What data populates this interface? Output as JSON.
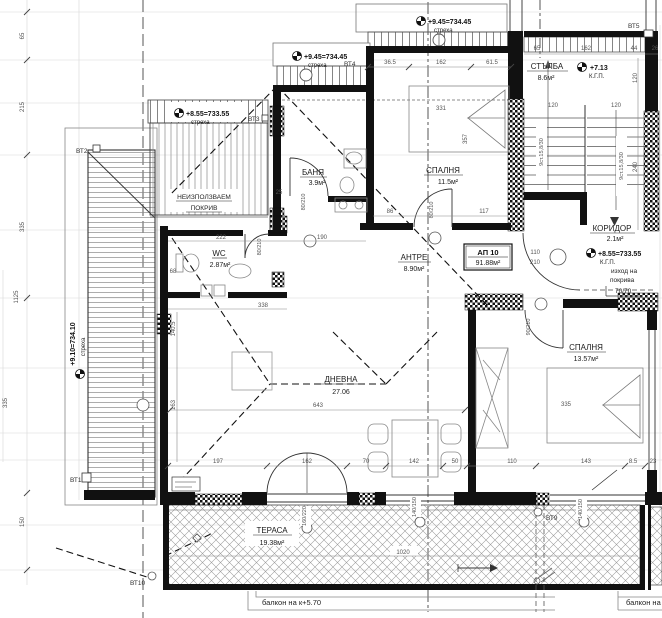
{
  "apartment": {
    "label": "АП 10",
    "area": "91.88м²"
  },
  "rooms": [
    {
      "name": "БАНЯ",
      "area": "3.9м²"
    },
    {
      "name": "СПАЛНЯ",
      "area": "11.5м²"
    },
    {
      "name": "СТЪЛБА",
      "area": "8.6м²"
    },
    {
      "name": "КОРИДОР",
      "area": "2.1м²"
    },
    {
      "name": "WC",
      "area": "2.87м²"
    },
    {
      "name": "АНТРЕ",
      "area": "8.90м²"
    },
    {
      "name": "ДНЕВНА",
      "area": "27.06"
    },
    {
      "name": "СПАЛНЯ",
      "area": "13.57м²"
    },
    {
      "name": "ТЕРАСА",
      "area": "19.38м²"
    },
    {
      "name": "НЕИЗПОЛЗВАЕМ",
      "area": "ПОКРИВ"
    }
  ],
  "elevations": [
    {
      "value": "+9.45=734.45",
      "sub": "стреха"
    },
    {
      "value": "+9.45=734.45",
      "sub": "стреха"
    },
    {
      "value": "+8.55=733.55",
      "sub": "стреха"
    },
    {
      "value": "+7.13",
      "sub": "К.Г.П."
    },
    {
      "value": "+8.55=733.55",
      "sub": "К.Г.П."
    },
    {
      "value": "+9.10=734.10",
      "sub": "стреха"
    }
  ],
  "roof_exit": {
    "line1": "изход на",
    "line2": "покрива",
    "size": "70/70"
  },
  "benchmarks": {
    "bt1": "ВТ1",
    "bt2": "ВТ2",
    "bt3": "ВТ3",
    "bt4": "ВТ4",
    "bt5": "ВТ5",
    "bt9": "ВТ9",
    "bt10": "ВТ10"
  },
  "stair_note": "9ст.15,8/30",
  "balcony": {
    "left": "балкон на к+5.70",
    "right": "балкон на"
  },
  "doors": [
    "80/210",
    "80/210",
    "80/210",
    "90/210"
  ],
  "hall_door": [
    "110",
    "210"
  ],
  "windows": [
    "140/150",
    "140/150",
    "160/220"
  ],
  "dims": {
    "left": [
      "65",
      "215",
      "335",
      "1125",
      "150",
      "335"
    ],
    "bed1_top": [
      "36.5",
      "162",
      "61.5"
    ],
    "bed1_in": [
      "331",
      "357"
    ],
    "bed1_bot": [
      "86",
      "117"
    ],
    "stair_top": [
      "65",
      "162",
      "44",
      "26"
    ],
    "stair_in": [
      "120",
      "120",
      "120",
      "240"
    ],
    "mid": [
      "222",
      "190",
      "25",
      "68",
      "338",
      "140.5",
      "163"
    ],
    "living": [
      "643"
    ],
    "bottom": [
      "197",
      "162",
      "70",
      "142",
      "50",
      "110",
      "143",
      "8.5",
      "23"
    ],
    "terrace": [
      "1020"
    ],
    "bed2": [
      "335"
    ]
  }
}
